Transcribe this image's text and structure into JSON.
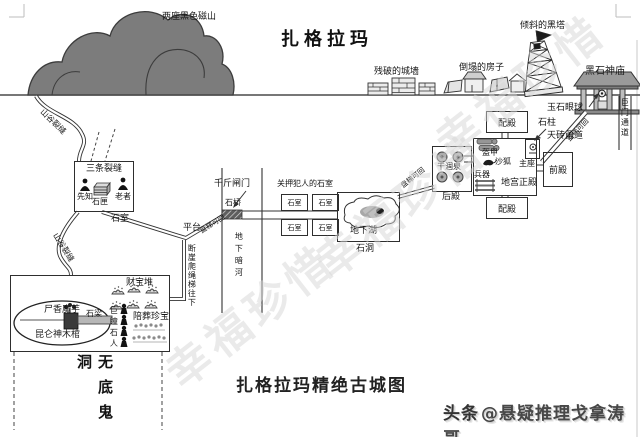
{
  "page": {
    "top_title": "扎格拉玛",
    "bottom_title": "扎格拉玛精绝古城图",
    "credit_logo": "头条",
    "credit_handle": "@悬疑推理戈拿涛哥",
    "watermark": "幸福珍惜"
  },
  "surface": {
    "mountains": "两座黑色磁山",
    "ruined_wall": "残破的城墙",
    "collapsed_houses": "倒塌的房子",
    "leaning_tower": "倾斜的黑塔",
    "temple": "黑石神庙",
    "jade_eyeball": "玉石眼球",
    "gate_passage": "巨门通道"
  },
  "palace": {
    "side_hall": "配殿",
    "front_hall": "前殿",
    "rear_hall": "后殿",
    "main_hall": "地宫正殿",
    "throne": "主座",
    "pillar": "石柱",
    "sky_brick_corridor": "天砖甬道",
    "armor": "盔甲",
    "sand_fox": "沙狐",
    "weapons": "兵器",
    "dry_spring": "干涸泉",
    "passage_note": "盘梯可回"
  },
  "underground": {
    "winch_gate": "千斤闸门",
    "bridge": "石桥",
    "dark_river": "地下暗河",
    "prison_label": "关押犯人的石室",
    "cell": "石室",
    "lake": "地下湖",
    "cave": "石洞",
    "platform": "平台",
    "cliff_note": "断崖爬绳梯往下",
    "passage_note": "盘梯可回"
  },
  "valley": {
    "crack_note": "山谷裂缝",
    "three_cracks": "三条裂缝",
    "prophet": "先知",
    "stone_casket": "石匣",
    "elder": "老者",
    "stone_room": "石室"
  },
  "tomb": {
    "treasure_pile": "财宝堆",
    "corpse_flower": "尸香魔芋",
    "stone_beam": "石梁",
    "coffin": "昆仑神木棺",
    "giant_pupil_statues": "巨瞳石人",
    "burial_treasure": "陪葬珍宝",
    "bottomless_pit": "无底鬼洞"
  }
}
